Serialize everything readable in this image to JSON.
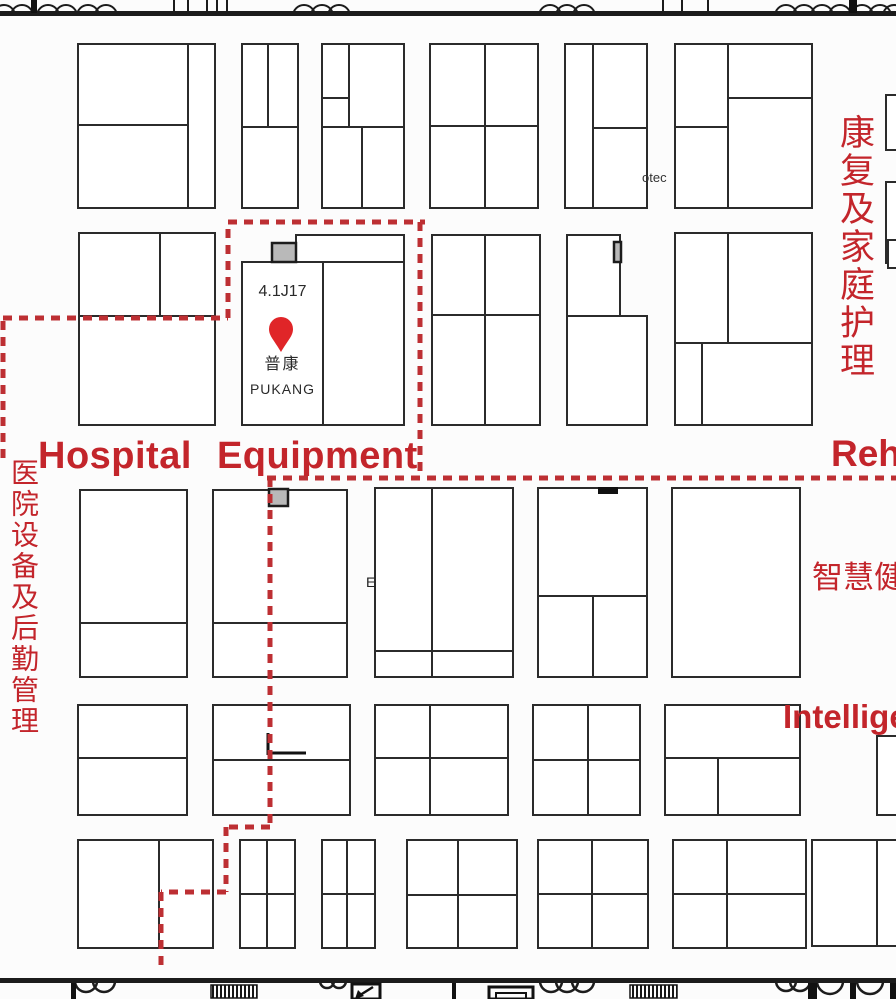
{
  "colors": {
    "accent_red": "#c3252b",
    "dash_red": "#bd2f33",
    "pin_red": "#e02528",
    "gray_fill": "#b9b9b9",
    "ink": "#242424"
  },
  "labels": {
    "hospital_equipment": "Hospital Equipment",
    "rehab_en": "Reh",
    "rehab_cn": "康复及家庭护理",
    "hospital_cn": "医院设备及后勤管理",
    "smart_cn": "智慧健",
    "intelligent_en": "Intellige",
    "otec": "otec",
    "e_mark": "E"
  },
  "pin_booth": {
    "id": "4.1J17",
    "name_cn": "普康",
    "name_en": "PUKANG"
  },
  "map": {
    "wall_rects": [
      [
        0,
        11,
        896,
        5
      ],
      [
        0,
        978,
        896,
        5
      ]
    ],
    "door_lines": [
      [
        174,
        0,
        174,
        11
      ],
      [
        188,
        0,
        188,
        11
      ],
      [
        207,
        0,
        207,
        11
      ],
      [
        217,
        0,
        217,
        11
      ],
      [
        227,
        0,
        227,
        11
      ],
      [
        663,
        0,
        663,
        11
      ],
      [
        682,
        0,
        682,
        11
      ],
      [
        708,
        0,
        708,
        11
      ]
    ],
    "trunks": [
      [
        31,
        0,
        6,
        13
      ],
      [
        849,
        0,
        8,
        13
      ],
      [
        71,
        983,
        5,
        16
      ],
      [
        808,
        983,
        9,
        16
      ],
      [
        850,
        983,
        6,
        16
      ],
      [
        890,
        983,
        6,
        16
      ],
      [
        452,
        983,
        4,
        16
      ]
    ],
    "petals_top": [
      4,
      22,
      48,
      66,
      88,
      106,
      304,
      322,
      339,
      550,
      567,
      584,
      786,
      804,
      822,
      840,
      862,
      880,
      894
    ],
    "petals_bottom": [
      [
        86,
        11
      ],
      [
        104,
        11
      ],
      [
        327,
        7
      ],
      [
        339,
        7
      ],
      [
        551,
        11
      ],
      [
        567,
        11
      ],
      [
        583,
        11
      ],
      [
        786,
        10
      ],
      [
        800,
        10
      ],
      [
        830,
        13
      ],
      [
        870,
        13
      ]
    ],
    "hatch_rects": [
      [
        211,
        985,
        46,
        13
      ],
      [
        630,
        985,
        47,
        13
      ]
    ],
    "nested_rects": [
      [
        489,
        987,
        44,
        12
      ],
      [
        496,
        993,
        30,
        6
      ]
    ],
    "arrow_box": {
      "rect": [
        352,
        984,
        28,
        15
      ],
      "line": [
        373,
        987,
        357,
        997
      ],
      "head": "355,999 364,996 358,990"
    },
    "booths": [
      [
        78,
        44,
        137,
        164
      ],
      [
        242,
        44,
        56,
        164
      ],
      [
        322,
        44,
        82,
        164
      ],
      [
        430,
        44,
        108,
        164
      ],
      [
        565,
        44,
        82,
        164
      ],
      [
        675,
        44,
        137,
        164
      ],
      [
        886,
        95,
        18,
        55
      ],
      [
        886,
        182,
        18,
        81
      ],
      [
        79,
        233,
        136,
        192
      ],
      [
        296,
        235,
        108,
        27
      ],
      [
        242,
        262,
        162,
        163
      ],
      [
        432,
        235,
        108,
        190
      ],
      [
        567,
        235,
        53,
        81
      ],
      [
        567,
        316,
        80,
        109
      ],
      [
        675,
        233,
        137,
        192
      ],
      [
        888,
        240,
        16,
        28
      ],
      [
        80,
        490,
        107,
        187
      ],
      [
        213,
        490,
        134,
        187
      ],
      [
        375,
        488,
        138,
        189
      ],
      [
        538,
        488,
        109,
        189
      ],
      [
        672,
        488,
        128,
        189
      ],
      [
        78,
        705,
        109,
        110
      ],
      [
        213,
        705,
        137,
        110
      ],
      [
        375,
        705,
        133,
        110
      ],
      [
        533,
        705,
        107,
        110
      ],
      [
        665,
        705,
        135,
        110
      ],
      [
        877,
        736,
        30,
        79
      ],
      [
        78,
        840,
        135,
        108
      ],
      [
        240,
        840,
        55,
        108
      ],
      [
        322,
        840,
        53,
        108
      ],
      [
        407,
        840,
        110,
        108
      ],
      [
        538,
        840,
        110,
        108
      ],
      [
        673,
        840,
        133,
        108
      ],
      [
        812,
        840,
        92,
        106
      ]
    ],
    "dividers": [
      [
        188,
        44,
        188,
        208
      ],
      [
        78,
        125,
        188,
        125
      ],
      [
        242,
        127,
        298,
        127
      ],
      [
        268,
        44,
        268,
        127
      ],
      [
        322,
        127,
        404,
        127
      ],
      [
        349,
        44,
        349,
        127
      ],
      [
        322,
        98,
        349,
        98
      ],
      [
        362,
        127,
        362,
        208
      ],
      [
        485,
        44,
        485,
        208
      ],
      [
        430,
        126,
        538,
        126
      ],
      [
        593,
        44,
        593,
        208
      ],
      [
        593,
        128,
        647,
        128
      ],
      [
        728,
        44,
        728,
        208
      ],
      [
        728,
        98,
        812,
        98
      ],
      [
        675,
        127,
        728,
        127
      ],
      [
        160,
        233,
        160,
        316
      ],
      [
        79,
        316,
        215,
        316
      ],
      [
        323,
        262,
        323,
        425
      ],
      [
        485,
        235,
        485,
        425
      ],
      [
        432,
        315,
        540,
        315
      ],
      [
        728,
        233,
        728,
        343
      ],
      [
        675,
        343,
        812,
        343
      ],
      [
        702,
        343,
        702,
        425
      ],
      [
        80,
        623,
        187,
        623
      ],
      [
        213,
        623,
        347,
        623
      ],
      [
        432,
        488,
        432,
        677
      ],
      [
        375,
        651,
        513,
        651
      ],
      [
        538,
        596,
        647,
        596
      ],
      [
        593,
        596,
        593,
        677
      ],
      [
        78,
        758,
        187,
        758
      ],
      [
        213,
        760,
        350,
        760
      ],
      [
        430,
        705,
        430,
        815
      ],
      [
        375,
        758,
        508,
        758
      ],
      [
        588,
        705,
        588,
        815
      ],
      [
        533,
        760,
        640,
        760
      ],
      [
        665,
        758,
        800,
        758
      ],
      [
        718,
        758,
        718,
        815
      ],
      [
        159,
        840,
        159,
        948
      ],
      [
        267,
        840,
        267,
        948
      ],
      [
        240,
        894,
        295,
        894
      ],
      [
        347,
        840,
        347,
        948
      ],
      [
        322,
        894,
        375,
        894
      ],
      [
        458,
        840,
        458,
        948
      ],
      [
        407,
        895,
        517,
        895
      ],
      [
        592,
        840,
        592,
        948
      ],
      [
        538,
        894,
        648,
        894
      ],
      [
        727,
        840,
        727,
        948
      ],
      [
        673,
        894,
        806,
        894
      ],
      [
        877,
        840,
        877,
        946
      ]
    ],
    "gray_rects": [
      [
        272,
        243,
        24,
        19
      ],
      [
        614,
        242,
        7,
        20
      ],
      [
        269,
        489,
        19,
        17
      ]
    ],
    "black_rects": [
      [
        598,
        487,
        20,
        7
      ]
    ],
    "bracket_lines": [
      [
        268,
        733,
        268,
        755
      ],
      [
        268,
        753,
        306,
        753
      ]
    ],
    "dashed_segments": [
      [
        3,
        458,
        3,
        318
      ],
      [
        3,
        318,
        228,
        318
      ],
      [
        228,
        318,
        228,
        222
      ],
      [
        228,
        222,
        425,
        222
      ],
      [
        420,
        222,
        420,
        478
      ],
      [
        267,
        478,
        896,
        478
      ],
      [
        270,
        478,
        270,
        827
      ],
      [
        270,
        827,
        226,
        827
      ],
      [
        226,
        827,
        226,
        892
      ],
      [
        226,
        892,
        161,
        892
      ],
      [
        161,
        892,
        161,
        972
      ]
    ],
    "pin": {
      "cx": 281,
      "top": 316,
      "tip": 352,
      "r": 12
    }
  }
}
